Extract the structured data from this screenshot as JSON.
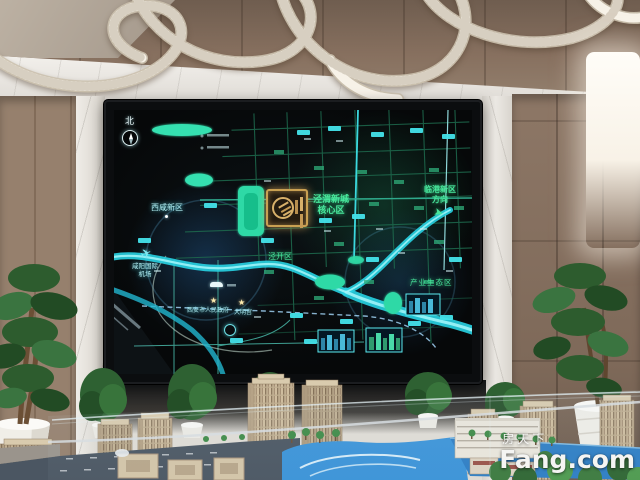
{
  "watermark": {
    "cn": "房天下",
    "en": "Fang.com"
  },
  "map": {
    "compass_label": "北",
    "labels": {
      "xixian": "西咸新区",
      "jingwei1": "泾渭新城",
      "jingwei2": "核心区",
      "lingang1": "临港新区",
      "lingang2": "方向",
      "industry": "产业生态区",
      "jingkai": "泾开区",
      "airport1": "咸阳国际",
      "airport2": "机场",
      "gov": "西安市人民政府",
      "daming": "大明宫"
    },
    "icons": {
      "star": "★",
      "arrow": "➤",
      "plane": "✈"
    },
    "colors": {
      "road_cyan": "#3fd9e2",
      "river_blue": "#27cfe0",
      "park_green": "#2fd9a6",
      "label_green": "#46e699",
      "logo_gold": "#c9a052"
    }
  }
}
